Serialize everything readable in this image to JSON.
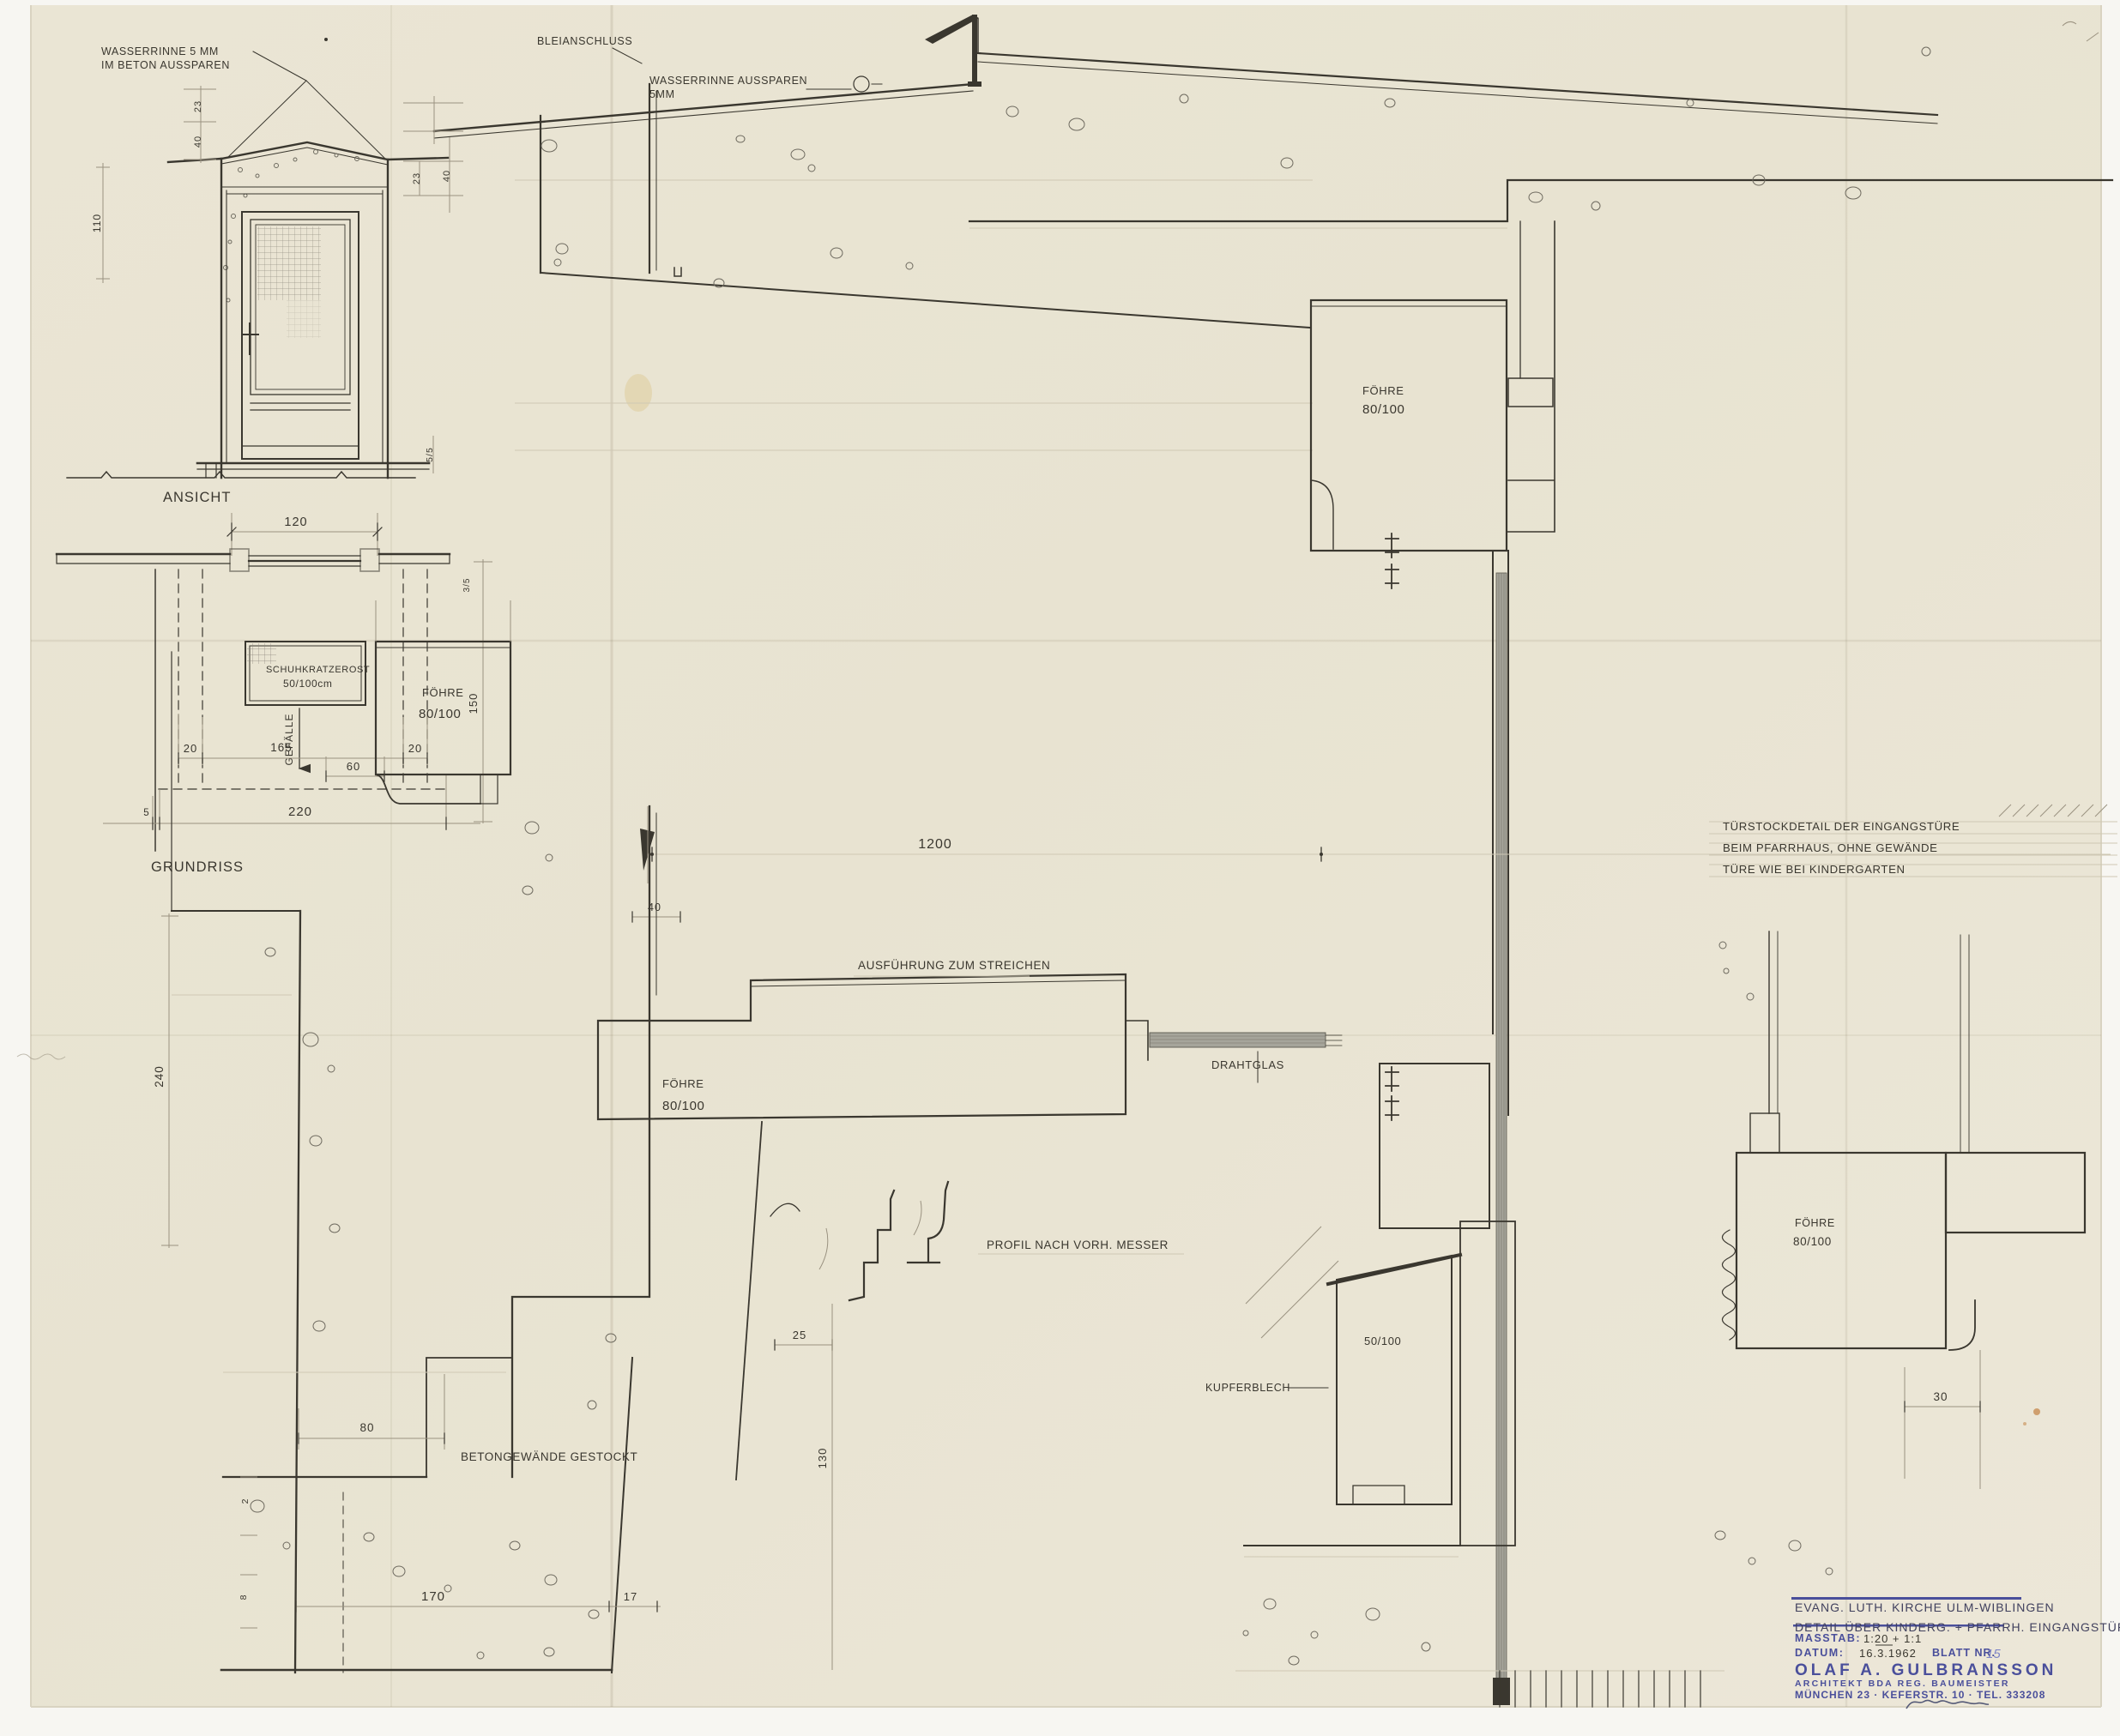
{
  "sheet": {
    "paper_color": "#e9e4d3",
    "ink_color": "#3a372f",
    "stamp_color": "#4a4f9b"
  },
  "views": {
    "elevation": {
      "title": "ANSICHT",
      "callout_line1": "WASSERRINNE 5 MM",
      "callout_line2": "IM BETON AUSSPAREN"
    },
    "plan": {
      "title": "GRUNDRISS",
      "grate_line1": "SCHUHKRATZEROST",
      "grate_line2": "50/100cm",
      "slope": "GEFÄLLE"
    },
    "section": {
      "bleianschluss": "BLEIANSCHLUSS",
      "wasserrinne_line1": "WASSERRINNE AUSSPAREN",
      "wasserrinne_line2": "5MM",
      "wood_species": "FÖHRE",
      "wood_size": "80/100",
      "paint_note": "AUSFÜHRUNG ZUM STREICHEN",
      "glass": "DRAHTGLAS",
      "profile_note": "PROFIL NACH VORH. MESSER",
      "concrete_note": "BETONGEWÄNDE GESTOCKT",
      "copper": "KUPFERBLECH",
      "wood_size_small": "50/100"
    },
    "note": {
      "line1": "TÜRSTOCKDETAIL DER EINGANGSTÜRE",
      "line2": "BEIM PFARRHAUS, OHNE GEWÄNDE",
      "line3": "TÜRE WIE BEI KINDERGARTEN"
    }
  },
  "dims": {
    "d2": "2",
    "d3_5": "3/5",
    "d5": "5",
    "d5_5": "5/5",
    "d8": "8",
    "d17": "17",
    "d20": "20",
    "d23": "23",
    "d25": "25",
    "d30": "30",
    "d40": "40",
    "d60": "60",
    "d80": "80",
    "d110": "110",
    "d120": "120",
    "d130": "130",
    "d150": "150",
    "d165": "165",
    "d170": "170",
    "d220": "220",
    "d240": "240",
    "d1200": "1200"
  },
  "title_block": {
    "project_line1": "EVANG. LUTH. KIRCHE ULM-WIBLINGEN",
    "project_line2": "DETAIL ÜBER KINDERG. + PFARRH. EINGANGSTÜREN",
    "scale_label": "MASSTAB:",
    "scale_value": "1:20 + 1:1",
    "date_label": "DATUM:",
    "date_value": "16.3.1962",
    "sheet_label": "BLATT NR.",
    "sheet_value": "15",
    "architect_name": "OLAF A. GULBRANSSON",
    "architect_title": "ARCHITEKT BDA REG. BAUMEISTER",
    "architect_address": "MÜNCHEN 23 · KEFERSTR. 10 · TEL. 333208"
  }
}
